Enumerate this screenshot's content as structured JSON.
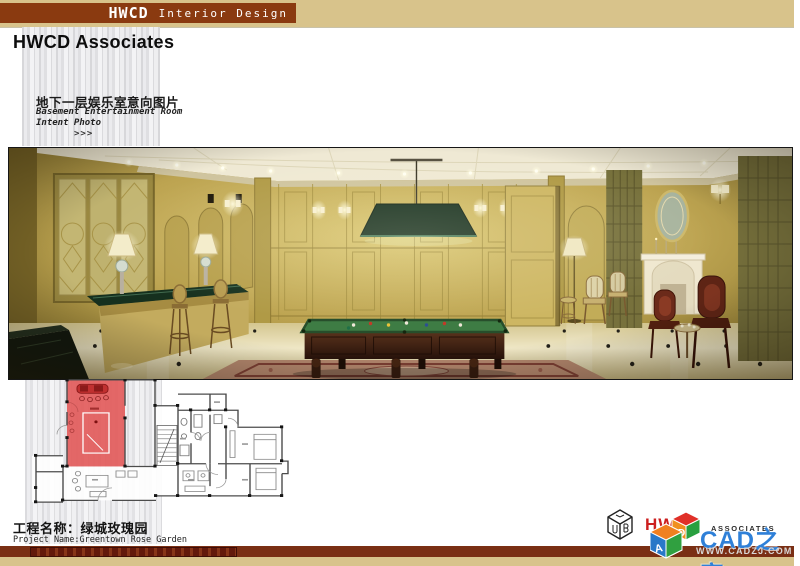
{
  "top_bar": {
    "brand": "HWCD",
    "brand_sub": "Interior Design"
  },
  "header": {
    "title": "HWCD Associates"
  },
  "section": {
    "title_zh": "地下一层娱乐室意向图片",
    "subtitle_en_line1": "Basement Entertainment Room",
    "subtitle_en_line2": "Intent Photo",
    "arrows": ">>>"
  },
  "photo": {
    "alt": "Basement entertainment room rendering: wood panelled billiards room with green pool table, billiard pendant lamp, bar counter with stools, fireplace and armchairs"
  },
  "floor_plan": {
    "alt": "Basement floor plan with billiards room highlighted in red",
    "highlight_color": "#e25c5c"
  },
  "footer": {
    "project_label_zh": "工程名称：绿城玫瑰园",
    "project_label_en": "Project Name:Greentown Rose Garden"
  },
  "logo": {
    "name": "HWCD",
    "subname": "ASSOCIATES"
  },
  "watermark": {
    "site_name": "CAD之家",
    "site_url": "WWW.CADZJ.COM"
  },
  "colors": {
    "top_bar_bg": "#d8c38b",
    "brand_bg": "#8a3a10",
    "footer_bar": "#7a2f14",
    "highlight_red": "#e25c5c",
    "logo_red": "#cc1f1f",
    "watermark_blue": "#2f80d8"
  }
}
